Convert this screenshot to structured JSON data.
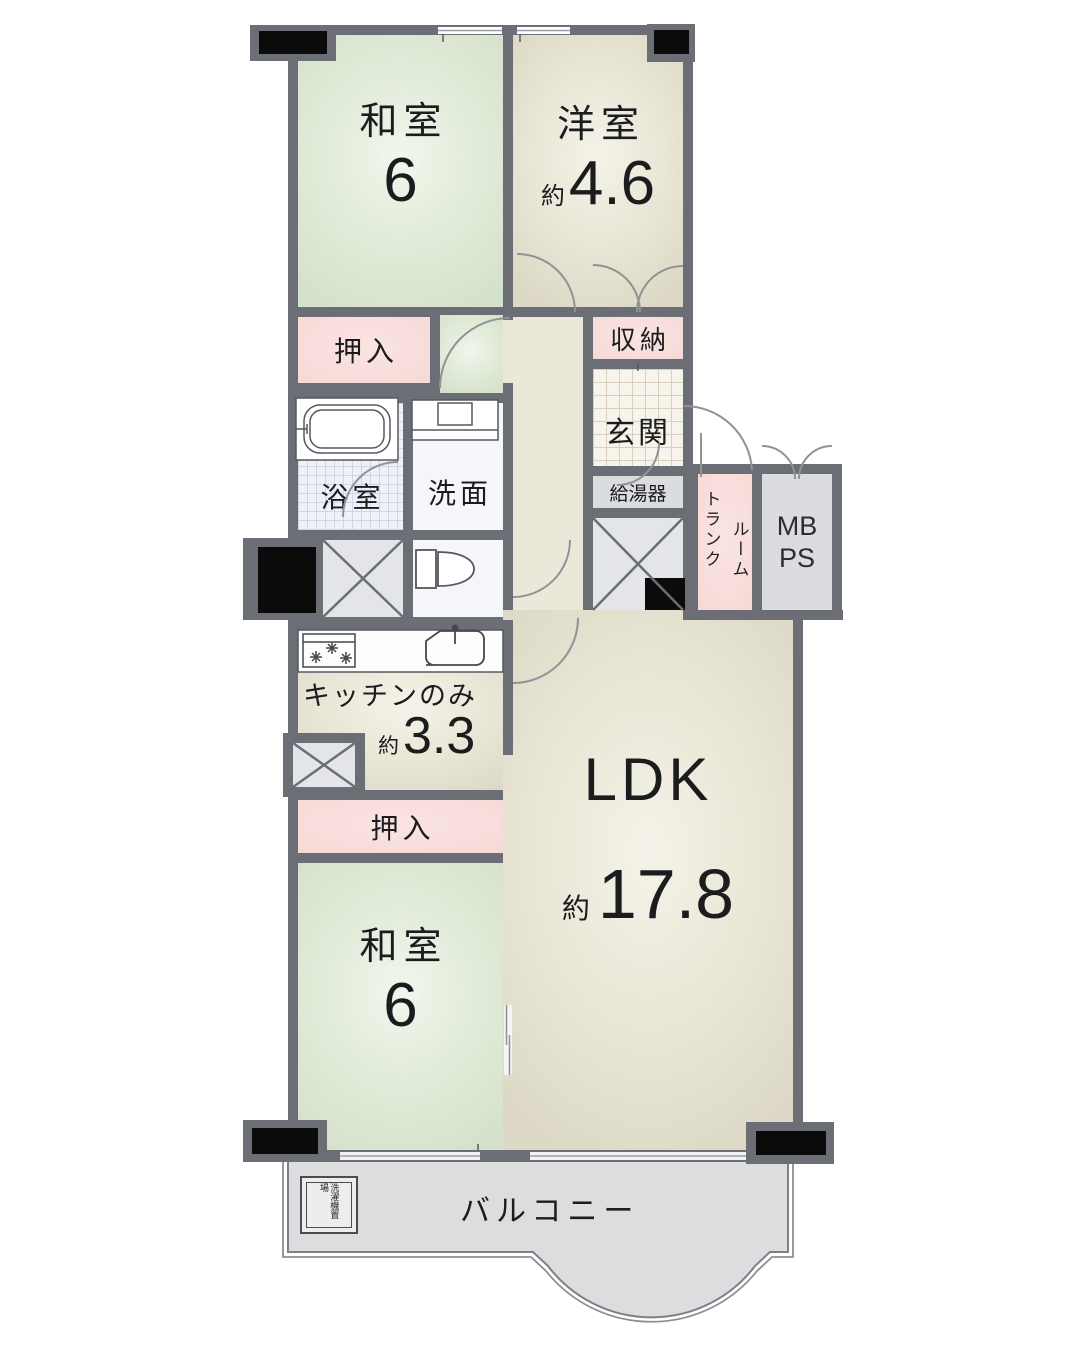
{
  "plan": {
    "rooms": {
      "washitsu_top": {
        "name": "和室",
        "area": "6"
      },
      "yoshitsu": {
        "name": "洋室",
        "area_prefix": "約",
        "area": "4.6"
      },
      "oshiire_top": {
        "label": "押入"
      },
      "shuunou": {
        "label": "収納"
      },
      "genkan": {
        "label": "玄関"
      },
      "bathroom": {
        "label": "浴室"
      },
      "senmen": {
        "label": "洗面"
      },
      "kyutoki": {
        "label": "給湯器"
      },
      "room_trunk": {
        "col_right": "ルーム",
        "col_left": "トランク"
      },
      "mbps": {
        "line1": "MB",
        "line2": "PS"
      },
      "kitchen": {
        "label": "キッチンのみ",
        "area_prefix": "約",
        "area": "3.3"
      },
      "oshiire_bottom": {
        "label": "押入"
      },
      "washitsu_bottom": {
        "name": "和室",
        "area": "6"
      },
      "ldk": {
        "name": "LDK",
        "area_prefix": "約",
        "area": "17.8"
      },
      "balcony": {
        "label": "バルコニー"
      },
      "laundry": {
        "label": "洗濯機置場"
      }
    },
    "colors": {
      "wall": "#6b6e75",
      "tatami_green": "#dfe9d8",
      "room_beige": "#e7e3d4",
      "closet_pink": "#f7dad8",
      "service_gray": "#dbdce0",
      "balcony_gray": "#dcddde",
      "pillar_black": "#0b0b0c"
    }
  }
}
